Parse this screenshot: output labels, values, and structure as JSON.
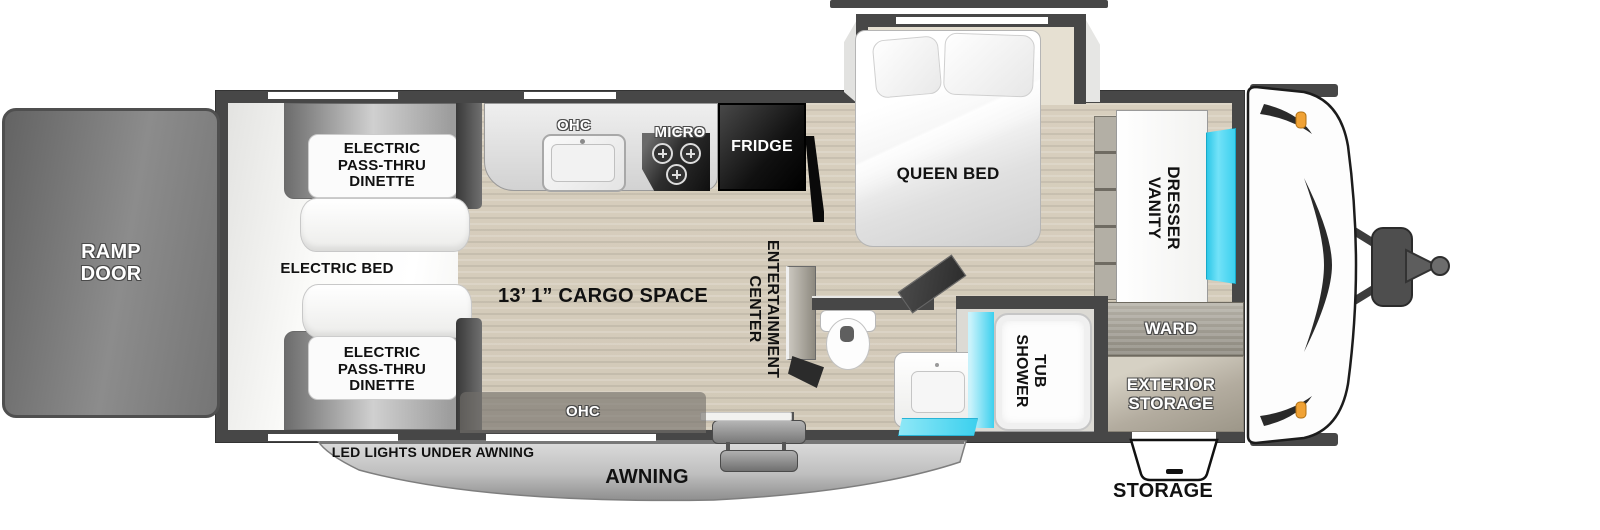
{
  "labels": {
    "ramp_door": "RAMP\nDOOR",
    "electric_pass_thru_dinette": "ELECTRIC\nPASS-THRU\nDINETTE",
    "electric_bed": "ELECTRIC BED",
    "ohc": "OHC",
    "micro": "MICRO",
    "fridge": "FRIDGE",
    "queen_bed": "QUEEN BED",
    "cargo_space": "13’ 1” CARGO SPACE",
    "entertainment_center": "ENTERTAINMENT\nCENTER",
    "dresser_vanity": "DRESSER\nVANITY",
    "ward": "WARD",
    "exterior_storage": "EXTERIOR\nSTORAGE",
    "tub_shower": "TUB\nSHOWER",
    "led_lights": "LED LIGHTS UNDER AWNING",
    "awning": "AWNING",
    "storage": "STORAGE"
  },
  "colors": {
    "wall_gray": "#474747",
    "accent_cyan": "#3cd0ee",
    "marker_orange": "#f0a235",
    "floor_wood": "#d2c9b8",
    "floor_garage": "#f4f4f2",
    "awning_gray": "#bfbfbf",
    "label_black": "#111111",
    "label_white": "#ffffff"
  }
}
